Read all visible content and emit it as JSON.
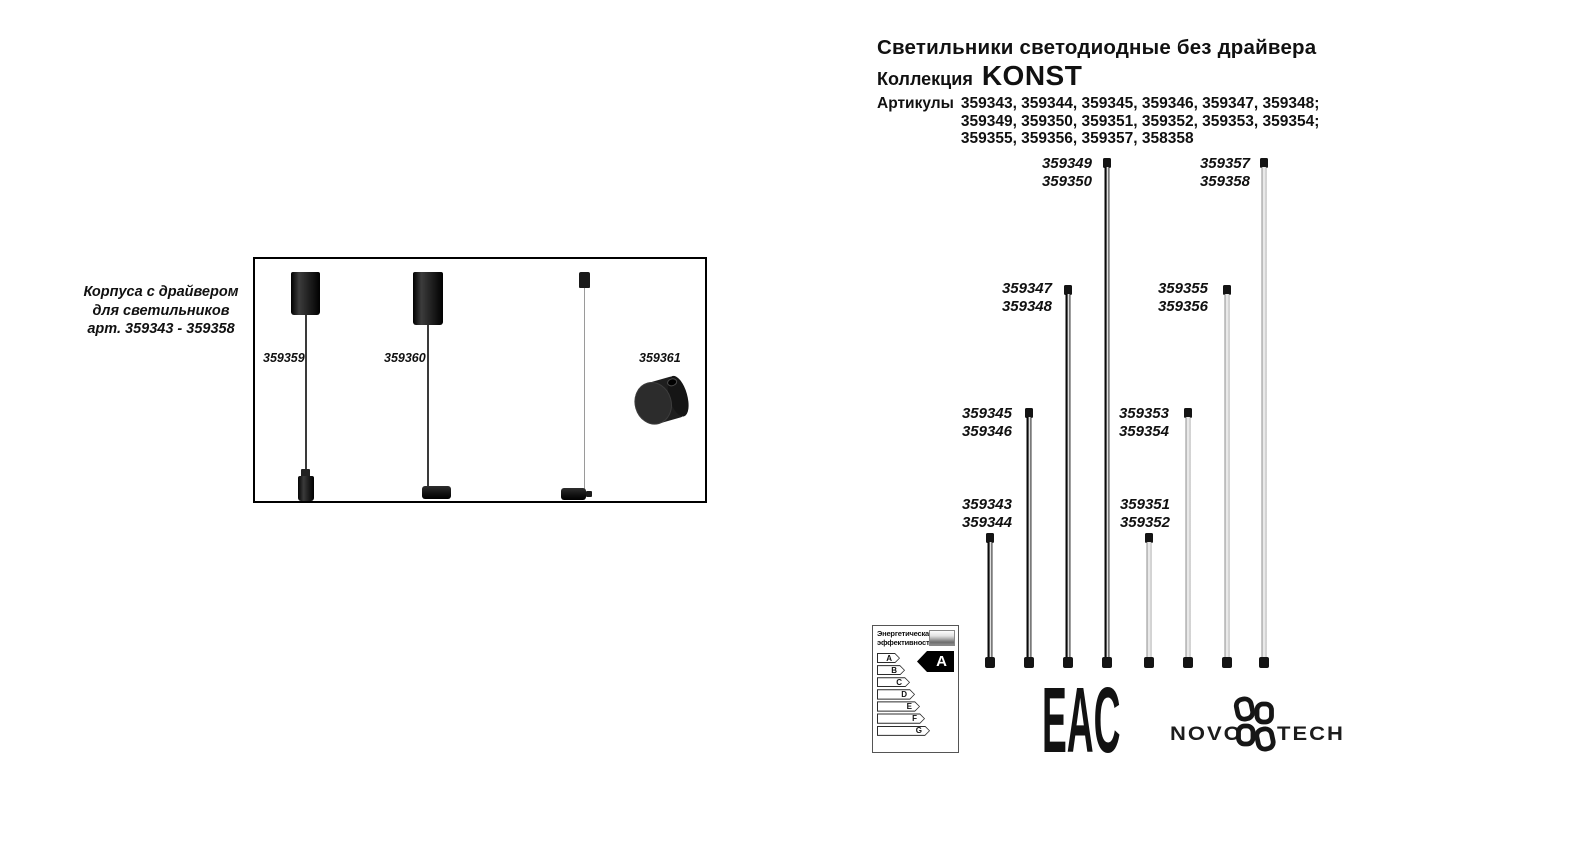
{
  "header": {
    "title": "Светильники светодиодные без драйвера",
    "collection_label": "Коллекция",
    "collection_name": "KONST",
    "articles_label": "Артикулы",
    "articles_line1": "359343, 359344, 359345, 359346, 359347, 359348;",
    "articles_line2": "359349, 359350, 359351, 359352, 359353, 359354;",
    "articles_line3": "359355, 359356, 359357, 358358"
  },
  "left_caption": {
    "line1": "Корпуса с драйвером",
    "line2": "для светильников",
    "line3": "арт. 359343 - 359358"
  },
  "housings": {
    "pendant1_article": "359359",
    "pendant2_article": "359360",
    "puck_article": "359361"
  },
  "rods": [
    {
      "line1": "359343",
      "line2": "359344",
      "finish": "black",
      "size": "small"
    },
    {
      "line1": "359345",
      "line2": "359346",
      "finish": "black",
      "size": "medium"
    },
    {
      "line1": "359347",
      "line2": "359348",
      "finish": "black",
      "size": "large"
    },
    {
      "line1": "359349",
      "line2": "359350",
      "finish": "black",
      "size": "xlarge"
    },
    {
      "line1": "359351",
      "line2": "359352",
      "finish": "white",
      "size": "small"
    },
    {
      "line1": "359353",
      "line2": "359354",
      "finish": "white",
      "size": "medium"
    },
    {
      "line1": "359355",
      "line2": "359356",
      "finish": "white",
      "size": "large"
    },
    {
      "line1": "359357",
      "line2": "359358",
      "finish": "white",
      "size": "xlarge"
    }
  ],
  "energy_label": {
    "title_line1": "Энергетическая",
    "title_line2": "эффективность",
    "classes": [
      "A",
      "B",
      "C",
      "D",
      "E",
      "F",
      "G"
    ],
    "rating": "A"
  },
  "certification": {
    "eac_text": "EAC"
  },
  "brand": {
    "name_left": "NOVO",
    "name_right": "TECH"
  },
  "icons": {
    "brand_glyph": "pinwheel-petals-icon",
    "energy_bar": "gradient-lamp-bar"
  },
  "colors": {
    "ink": "#111111",
    "rod_dark": "#1a1a1a",
    "rod_light": "#d9d9d9",
    "background": "#ffffff"
  }
}
